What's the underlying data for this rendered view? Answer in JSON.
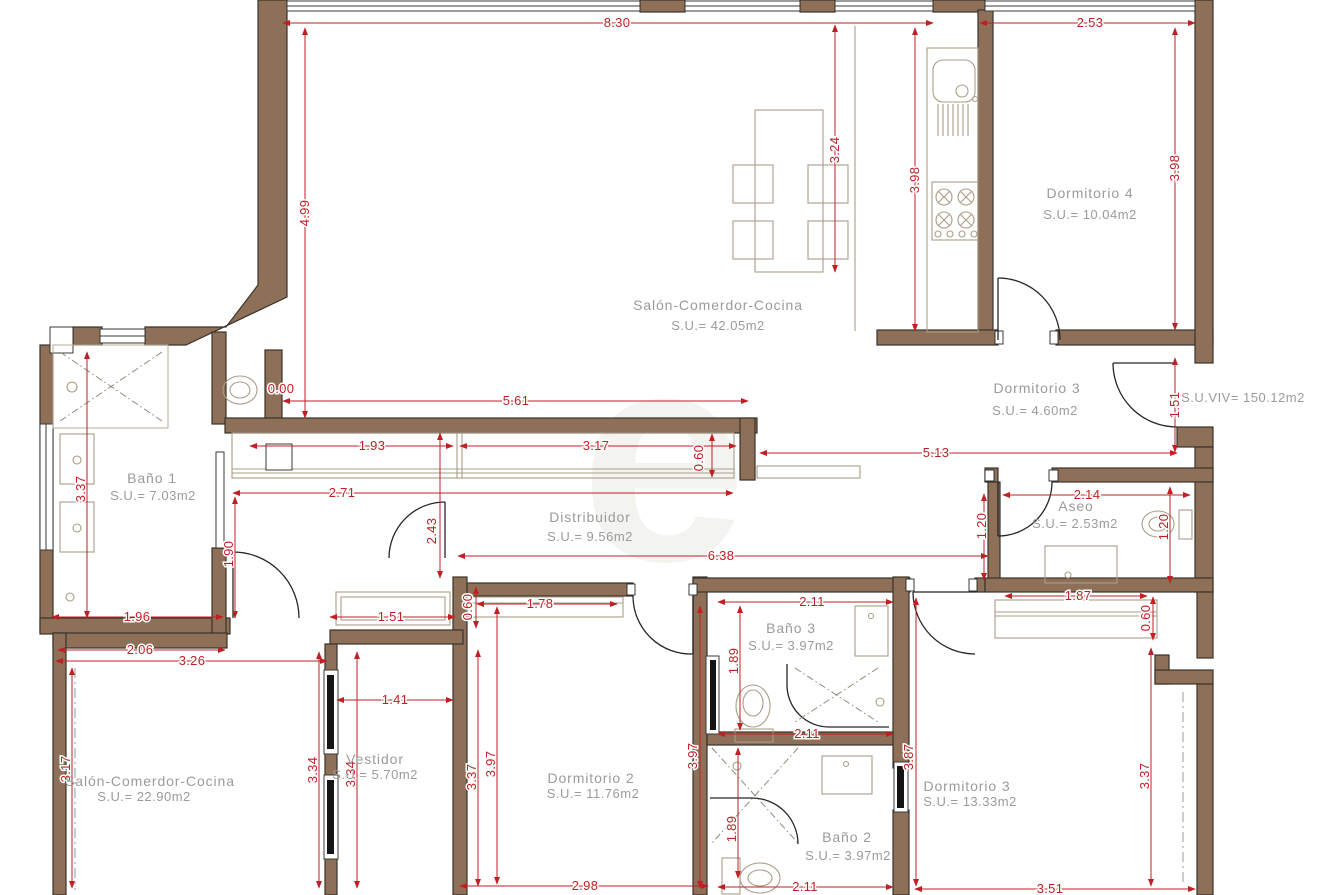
{
  "colors": {
    "wall": "#8d7057",
    "dimension": "#c02024",
    "label": "#9b9b9b"
  },
  "watermark": "e",
  "total_label": "S.U.VIV= 150.12m2",
  "rooms": [
    {
      "name": "Salón-Comerdor-Cocina",
      "area": "S.U.= 42.05m2"
    },
    {
      "name": "Dormitorio 4",
      "area": "S.U.= 10.04m2"
    },
    {
      "name": "Dormitorio 3",
      "area": "S.U.= 4.60m2"
    },
    {
      "name": "Baño 1",
      "area": "S.U.= 7.03m2"
    },
    {
      "name": "Distribuidor",
      "area": "S.U.= 9.56m2"
    },
    {
      "name": "Aseo",
      "area": "S.U.= 2.53m2"
    },
    {
      "name": "Salón-Comerdor-Cocina",
      "area": "S.U.= 22.90m2"
    },
    {
      "name": "Vestidor",
      "area": "S.U.= 5.70m2"
    },
    {
      "name": "Dormitorio 2",
      "area": "S.U.= 11.76m2"
    },
    {
      "name": "Baño 3",
      "area": "S.U.= 3.97m2"
    },
    {
      "name": "Baño 2",
      "area": "S.U.= 3.97m2"
    },
    {
      "name": "Dormitorio 3",
      "area": "S.U.= 13.33m2"
    }
  ],
  "dims": [
    "8.30",
    "2.53",
    "4.99",
    "3.24",
    "3.98",
    "3.98",
    "0.00",
    "5.61",
    "1.93",
    "3.17",
    "0.60",
    "5.13",
    "2.71",
    "2.43",
    "2.14",
    "1.51",
    "1.20",
    "1.20",
    "6.38",
    "1.96",
    "2.06",
    "3.26",
    "1.51",
    "1.41",
    "0.60",
    "1.78",
    "2.11",
    "1.87",
    "0.60",
    "1.89",
    "2.11",
    "3.97",
    "3.87",
    "1.89",
    "2.98",
    "2.11",
    "3.51",
    "3.37",
    "3.17",
    "3.34",
    "3.34",
    "3.37",
    "3.97",
    "1.90",
    "3.37"
  ]
}
